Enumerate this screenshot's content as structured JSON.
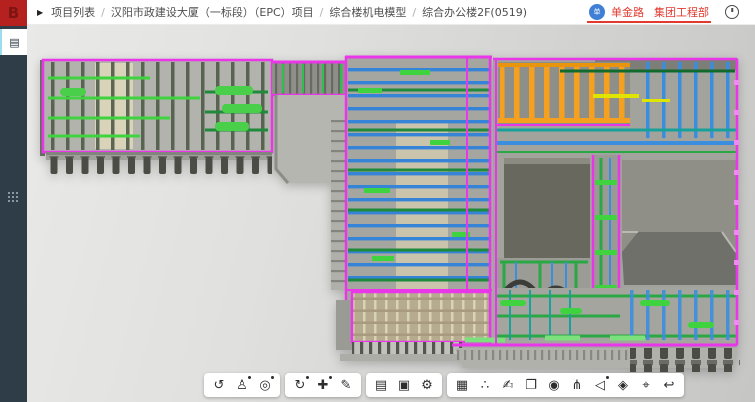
{
  "topbar": {
    "breadcrumb_arrow": "▶",
    "separator": "/",
    "breadcrumb": [
      {
        "label": "项目列表"
      },
      {
        "label": "汉阳市政建设大厦（一标段）（EPC）项目"
      },
      {
        "label": "综合楼机电模型"
      },
      {
        "label": "综合办公楼2F(0519)"
      }
    ],
    "user": {
      "avatar_text": "单",
      "name": "单金路",
      "department": "集团工程部",
      "accent_color": "#e23a2e",
      "avatar_color": "#3f7fd6"
    }
  },
  "sidebar": {
    "logo_text": "B",
    "logo_bg": "#b5211e",
    "items": [
      {
        "name": "model-panel",
        "icon": "layers-icon",
        "glyph": "▤",
        "active": true
      },
      {
        "name": "apps-grid",
        "icon": "grid-icon",
        "active": false
      }
    ]
  },
  "toolbar": {
    "groups": [
      {
        "icons": [
          {
            "name": "orbit-icon",
            "glyph": "↺"
          },
          {
            "name": "walk-mode-icon",
            "glyph": "♙",
            "dot": true
          },
          {
            "name": "zoom-window-icon",
            "glyph": "◎",
            "dot": true
          }
        ]
      },
      {
        "icons": [
          {
            "name": "rotate-view-icon",
            "glyph": "↻",
            "dot": true
          },
          {
            "name": "pan-move-icon",
            "glyph": "✚",
            "dot": true
          },
          {
            "name": "measure-icon",
            "glyph": "✎"
          }
        ]
      },
      {
        "icons": [
          {
            "name": "document-icon",
            "glyph": "▤"
          },
          {
            "name": "save-view-icon",
            "glyph": "▣"
          },
          {
            "name": "settings-gear-icon",
            "glyph": "⚙"
          }
        ]
      },
      {
        "icons": [
          {
            "name": "model-box-icon",
            "glyph": "▦"
          },
          {
            "name": "share-icon",
            "glyph": "∴"
          },
          {
            "name": "markup-hand-icon",
            "glyph": "✍"
          },
          {
            "name": "copy-icon",
            "glyph": "❐"
          },
          {
            "name": "snapshot-icon",
            "glyph": "◉"
          },
          {
            "name": "structure-tree-icon",
            "glyph": "⋔"
          },
          {
            "name": "section-icon",
            "glyph": "◁",
            "dot": true
          },
          {
            "name": "material-icon",
            "glyph": "◈"
          },
          {
            "name": "fit-view-icon",
            "glyph": "⌖"
          },
          {
            "name": "reset-view-icon",
            "glyph": "↩"
          }
        ]
      }
    ]
  },
  "model": {
    "colors": {
      "pipe_magenta": "#e836e8",
      "pipe_green": "#2aa845",
      "pipe_green_bright": "#3fd43f",
      "pipe_blue": "#3b8ede",
      "pipe_teal": "#18a09a",
      "duct_orange": "#f5a11f",
      "pipe_yellow": "#dfe400",
      "structure_gray": "#a6a6a0",
      "beige_structure": "#cfc8ae",
      "void_dark": "#68685f",
      "footing_dark": "#4c4c47"
    }
  }
}
